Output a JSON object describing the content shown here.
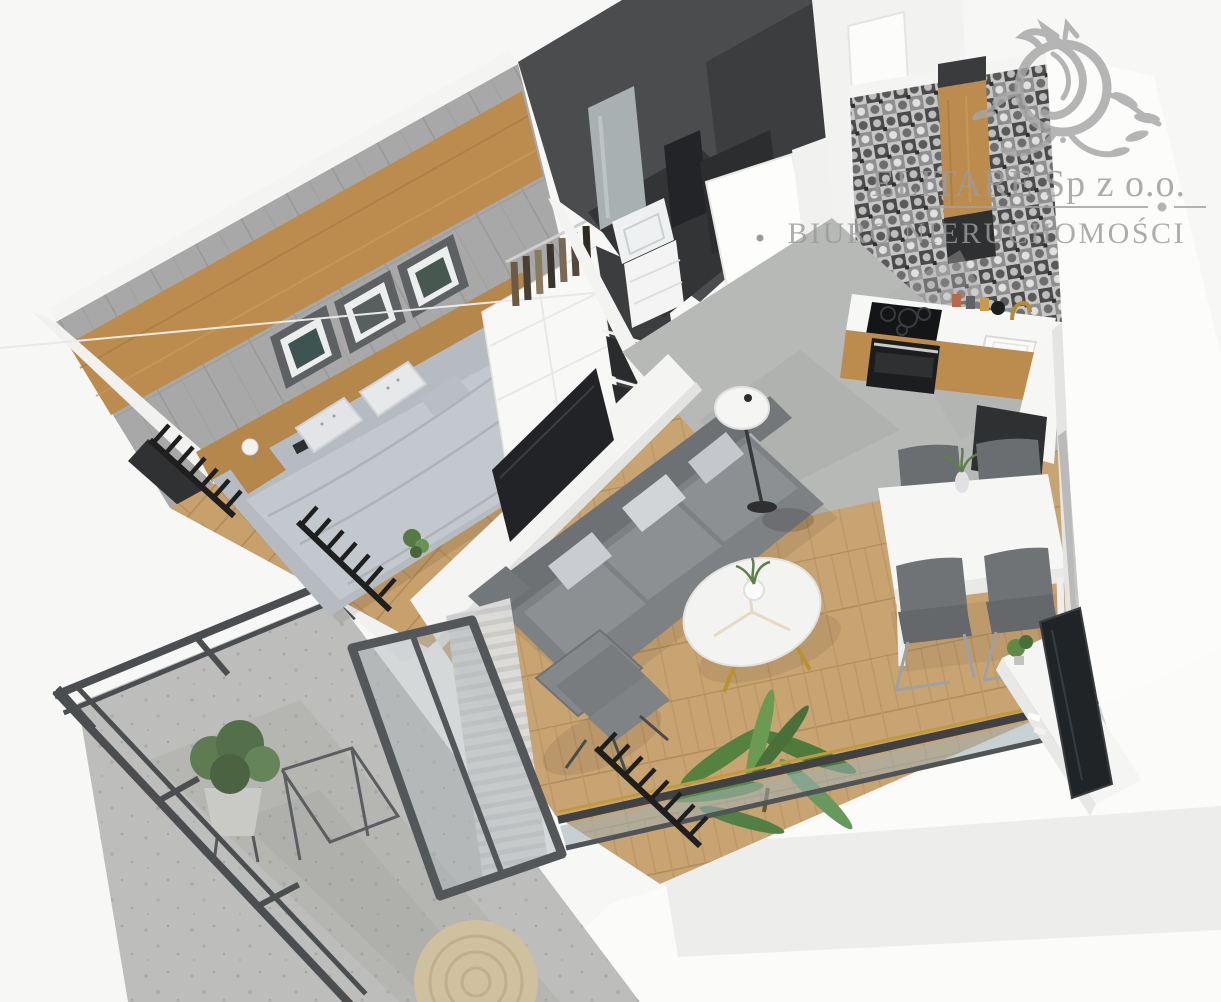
{
  "watermark": {
    "company": "ELITARE Sp z o.o.",
    "subtitle": "BIURO NIERUCHOMOŚCI",
    "logo_icon": "ornamental-crest-logo"
  },
  "palette": {
    "background": "#f7f7f6",
    "wall_white": "#f4f4f3",
    "concrete_wall": "#a8a8a8",
    "wood_accent": "#b5874b",
    "charcoal": "#3c3d3f",
    "wood_floor": "#c7a06c",
    "concrete_floor": "#b7b9b7",
    "terrazzo": "#bdbdbb",
    "sofa_gray": "#7e8184",
    "railing_dark": "#4b4e50",
    "plant_green": "#5d8a45",
    "brass": "#b8922e",
    "watermark_gray": "#9b9b9b"
  }
}
